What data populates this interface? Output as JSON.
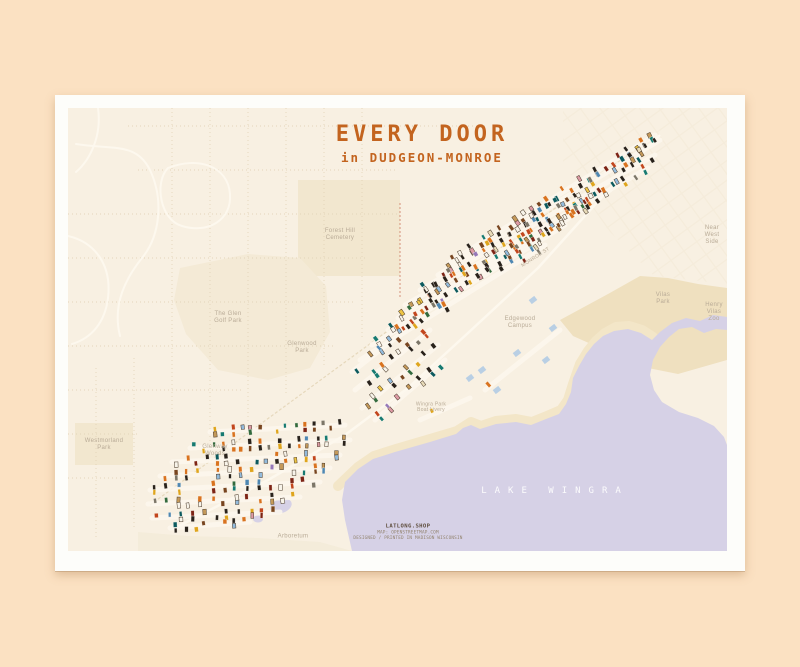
{
  "poster": {
    "title": "EVERY DOOR",
    "subtitle": "in DUDGEON-MONROE"
  },
  "lake_label": "LAKE WINGRA",
  "attribution": {
    "line1": "LATLONG.SHOP",
    "line2": "MAP: OPENSTREETMAP.COM",
    "line3": "DESIGNED / PRINTED IN MADISON WISCONSIN"
  },
  "map_labels": [
    {
      "name": "forest-hill-cemetery",
      "x": 272,
      "y": 127,
      "lines": [
        "Forest Hill",
        "Cemetery"
      ]
    },
    {
      "name": "the-glen-golf-park",
      "x": 160,
      "y": 210,
      "lines": [
        "The Glen",
        "Golf Park"
      ]
    },
    {
      "name": "glenwood-park",
      "x": 234,
      "y": 240,
      "lines": [
        "Glenwood",
        "Park"
      ]
    },
    {
      "name": "edgewood-campus",
      "x": 452,
      "y": 215,
      "lines": [
        "Edgewood",
        "Campus"
      ]
    },
    {
      "name": "vilas-park",
      "x": 595,
      "y": 191,
      "lines": [
        "Vilas",
        "Park"
      ]
    },
    {
      "name": "henry-vilas-zoo",
      "x": 646,
      "y": 205,
      "lines": [
        "Henry",
        "Vilas",
        "Zoo"
      ]
    },
    {
      "name": "near-west-side",
      "x": 644,
      "y": 128,
      "lines": [
        "Near",
        "West",
        "Side"
      ]
    },
    {
      "name": "westmorland-park",
      "x": 36,
      "y": 337,
      "lines": [
        "Westmorland",
        "Park"
      ]
    },
    {
      "name": "glenway-woods",
      "x": 147,
      "y": 343,
      "lines": [
        "Glenway",
        "Woods"
      ]
    },
    {
      "name": "wingra-park",
      "x": 363,
      "y": 300,
      "lines": [
        "Wingra Park",
        "Boat Livery"
      ],
      "size": 5
    },
    {
      "name": "arboretum",
      "x": 225,
      "y": 429,
      "lines": [
        "Arboretum"
      ]
    },
    {
      "name": "monroe-street",
      "x": 468,
      "y": 150,
      "lines": [
        "MONROE ST"
      ],
      "size": 5,
      "rotate": -33
    }
  ],
  "colors": {
    "bg": "#fbe1c2",
    "mat": "#fdfdfa",
    "map_bg": "#f8f0e2",
    "lake": "#d6d1e6",
    "shore": "#f3e6c8",
    "land1": "#f4ead6",
    "land2": "#f2e7cf",
    "vilas": "#efe0bf",
    "arb": "#f4ecda",
    "accent": "#c3641f",
    "label": "#b9ab97",
    "street": "#fdf8ee",
    "grid_dot": "#e0d1b4",
    "grid_tr": "#f5ecdb",
    "trail": "#e6d8bc",
    "rail": "#d4917a",
    "attr1": "#5f4e3e",
    "attr2": "#93846f",
    "building": "#b9cfe4"
  },
  "seed": 20,
  "door_palette": [
    {
      "c": "#29221b",
      "w": 5
    },
    {
      "c": "#f8f4ea",
      "w": 3
    },
    {
      "c": "#d9731f",
      "w": 3
    },
    {
      "c": "#c2461d",
      "w": 2
    },
    {
      "c": "#177a71",
      "w": 2
    },
    {
      "c": "#0c5a5e",
      "w": 1
    },
    {
      "c": "#93bbdc",
      "w": 1.5
    },
    {
      "c": "#4e87b2",
      "w": 1
    },
    {
      "c": "#dfa51d",
      "w": 2
    },
    {
      "c": "#eec545",
      "w": 1
    },
    {
      "c": "#78451f",
      "w": 2
    },
    {
      "c": "#c4995a",
      "w": 1.5
    },
    {
      "c": "#7d2415",
      "w": 1
    },
    {
      "c": "#336a3d",
      "w": 1
    },
    {
      "c": "#7c7668",
      "w": 1
    },
    {
      "c": "#dc9aa4",
      "w": 0.7
    },
    {
      "c": "#9678b8",
      "w": 0.4
    },
    {
      "c": "#e9dcba",
      "w": 0.8
    }
  ],
  "door_light": [
    "#f8f4ea",
    "#eec545",
    "#c4995a",
    "#93bbdc",
    "#e9dcba",
    "#dc9aa4"
  ],
  "door_segments": [
    [
      382,
      154,
      587,
      27,
      26,
      0
    ],
    [
      370,
      167,
      592,
      32,
      27,
      0
    ],
    [
      352,
      182,
      587,
      47,
      27,
      0
    ],
    [
      337,
      197,
      580,
      60,
      26,
      0
    ],
    [
      330,
      210,
      542,
      82,
      23,
      0
    ],
    [
      320,
      222,
      522,
      97,
      21,
      0
    ],
    [
      304,
      237,
      497,
      117,
      19,
      0
    ],
    [
      292,
      252,
      477,
      137,
      12,
      1
    ],
    [
      284,
      264,
      357,
      207,
      9,
      0
    ],
    [
      287,
      282,
      362,
      222,
      9,
      0
    ],
    [
      294,
      300,
      370,
      237,
      9,
      0
    ],
    [
      307,
      312,
      377,
      252,
      7,
      0
    ],
    [
      352,
      312,
      402,
      290,
      6,
      1
    ],
    [
      142,
      324,
      277,
      317,
      15,
      0
    ],
    [
      122,
      340,
      282,
      332,
      17,
      0
    ],
    [
      104,
      354,
      272,
      347,
      17,
      0
    ],
    [
      92,
      368,
      262,
      360,
      16,
      0
    ],
    [
      82,
      382,
      252,
      374,
      15,
      0
    ],
    [
      80,
      396,
      232,
      389,
      13,
      0
    ],
    [
      84,
      410,
      212,
      404,
      11,
      0
    ],
    [
      102,
      420,
      182,
      414,
      8,
      0
    ],
    [
      417,
      282,
      492,
      222,
      7,
      1
    ]
  ],
  "buildings": [
    [
      485,
      220
    ],
    [
      449,
      245
    ],
    [
      414,
      262
    ],
    [
      429,
      282
    ],
    [
      465,
      192
    ],
    [
      402,
      270
    ],
    [
      478,
      252
    ]
  ]
}
